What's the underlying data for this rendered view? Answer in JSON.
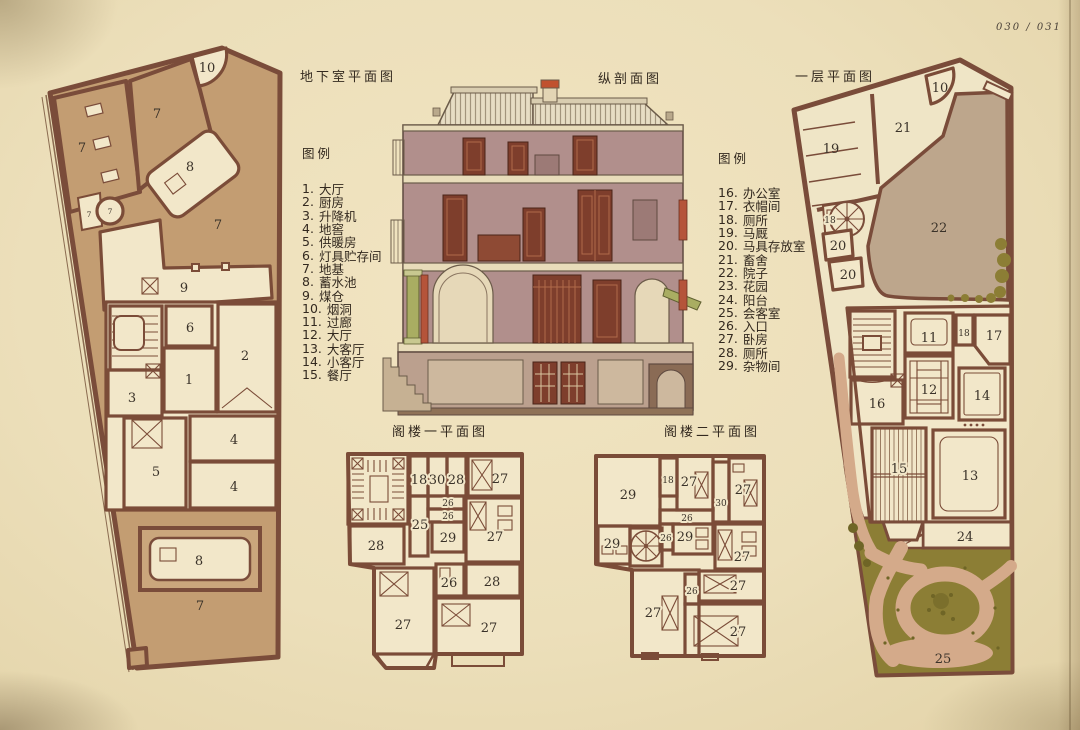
{
  "page": {
    "folio": "030 / 031"
  },
  "titles": {
    "basement": "地下室平面图",
    "section": "纵剖面图",
    "first_floor": "一层平面图",
    "attic1": "阁楼一平面图",
    "attic2": "阁楼二平面图"
  },
  "legend_left": {
    "title": "图例",
    "items": [
      {
        "num": "1.",
        "label": "大厅"
      },
      {
        "num": "2.",
        "label": "厨房"
      },
      {
        "num": "3.",
        "label": "升降机"
      },
      {
        "num": "4.",
        "label": "地窖"
      },
      {
        "num": "5.",
        "label": "供暖房"
      },
      {
        "num": "6.",
        "label": "灯具贮存间"
      },
      {
        "num": "7.",
        "label": "地基"
      },
      {
        "num": "8.",
        "label": "蓄水池"
      },
      {
        "num": "9.",
        "label": "煤仓"
      },
      {
        "num": "10.",
        "label": "烟洞"
      },
      {
        "num": "11.",
        "label": "过廊"
      },
      {
        "num": "12.",
        "label": "大厅"
      },
      {
        "num": "13.",
        "label": "大客厅"
      },
      {
        "num": "14.",
        "label": "小客厅"
      },
      {
        "num": "15.",
        "label": "餐厅"
      }
    ]
  },
  "legend_right": {
    "title": "图例",
    "items": [
      {
        "num": "16.",
        "label": "办公室"
      },
      {
        "num": "17.",
        "label": "衣帽间"
      },
      {
        "num": "18.",
        "label": "厕所"
      },
      {
        "num": "19.",
        "label": "马厩"
      },
      {
        "num": "20.",
        "label": "马具存放室"
      },
      {
        "num": "21.",
        "label": "畜舍"
      },
      {
        "num": "22.",
        "label": "院子"
      },
      {
        "num": "23.",
        "label": "花园"
      },
      {
        "num": "24.",
        "label": "阳台"
      },
      {
        "num": "25.",
        "label": "会客室"
      },
      {
        "num": "26.",
        "label": "入口"
      },
      {
        "num": "27.",
        "label": "卧房"
      },
      {
        "num": "28.",
        "label": "厕所"
      },
      {
        "num": "29.",
        "label": "杂物间"
      }
    ]
  },
  "plans": {
    "basement": {
      "labels": [
        "10",
        "7",
        "7",
        "8",
        "7",
        "7",
        "7",
        "9",
        "6",
        "2",
        "1",
        "3",
        "5",
        "4",
        "4",
        "8",
        "7"
      ]
    },
    "first_floor": {
      "labels": [
        "10",
        "21",
        "19",
        "18",
        "20",
        "20",
        "22",
        "11",
        "18",
        "17",
        "12",
        "16",
        "14",
        "15",
        "13",
        "24",
        "25"
      ]
    },
    "attic1": {
      "labels": [
        "18",
        "30",
        "28",
        "27",
        "26",
        "26",
        "25",
        "29",
        "27",
        "28",
        "26",
        "28",
        "27",
        "27"
      ]
    },
    "attic2": {
      "labels": [
        "29",
        "18",
        "27",
        "30",
        "27",
        "26",
        "29",
        "26",
        "29",
        "27",
        "27",
        "26",
        "27",
        "27"
      ]
    }
  },
  "colors": {
    "paper": "#ecdfba",
    "wall_brown": "#7b4c38",
    "site_tan": "#c39d72",
    "room_cream": "#f2e7c9",
    "courtyard_taupe": "#bda68c",
    "garden_olive": "#8c7e35",
    "path_pink": "#d4aa8a",
    "section_wall_mauve": "#b18f8c",
    "section_door_red": "#7e3e2c",
    "accent_green": "#a9ad62",
    "chimney_red": "#c0512f",
    "ink": "#3a3229"
  }
}
